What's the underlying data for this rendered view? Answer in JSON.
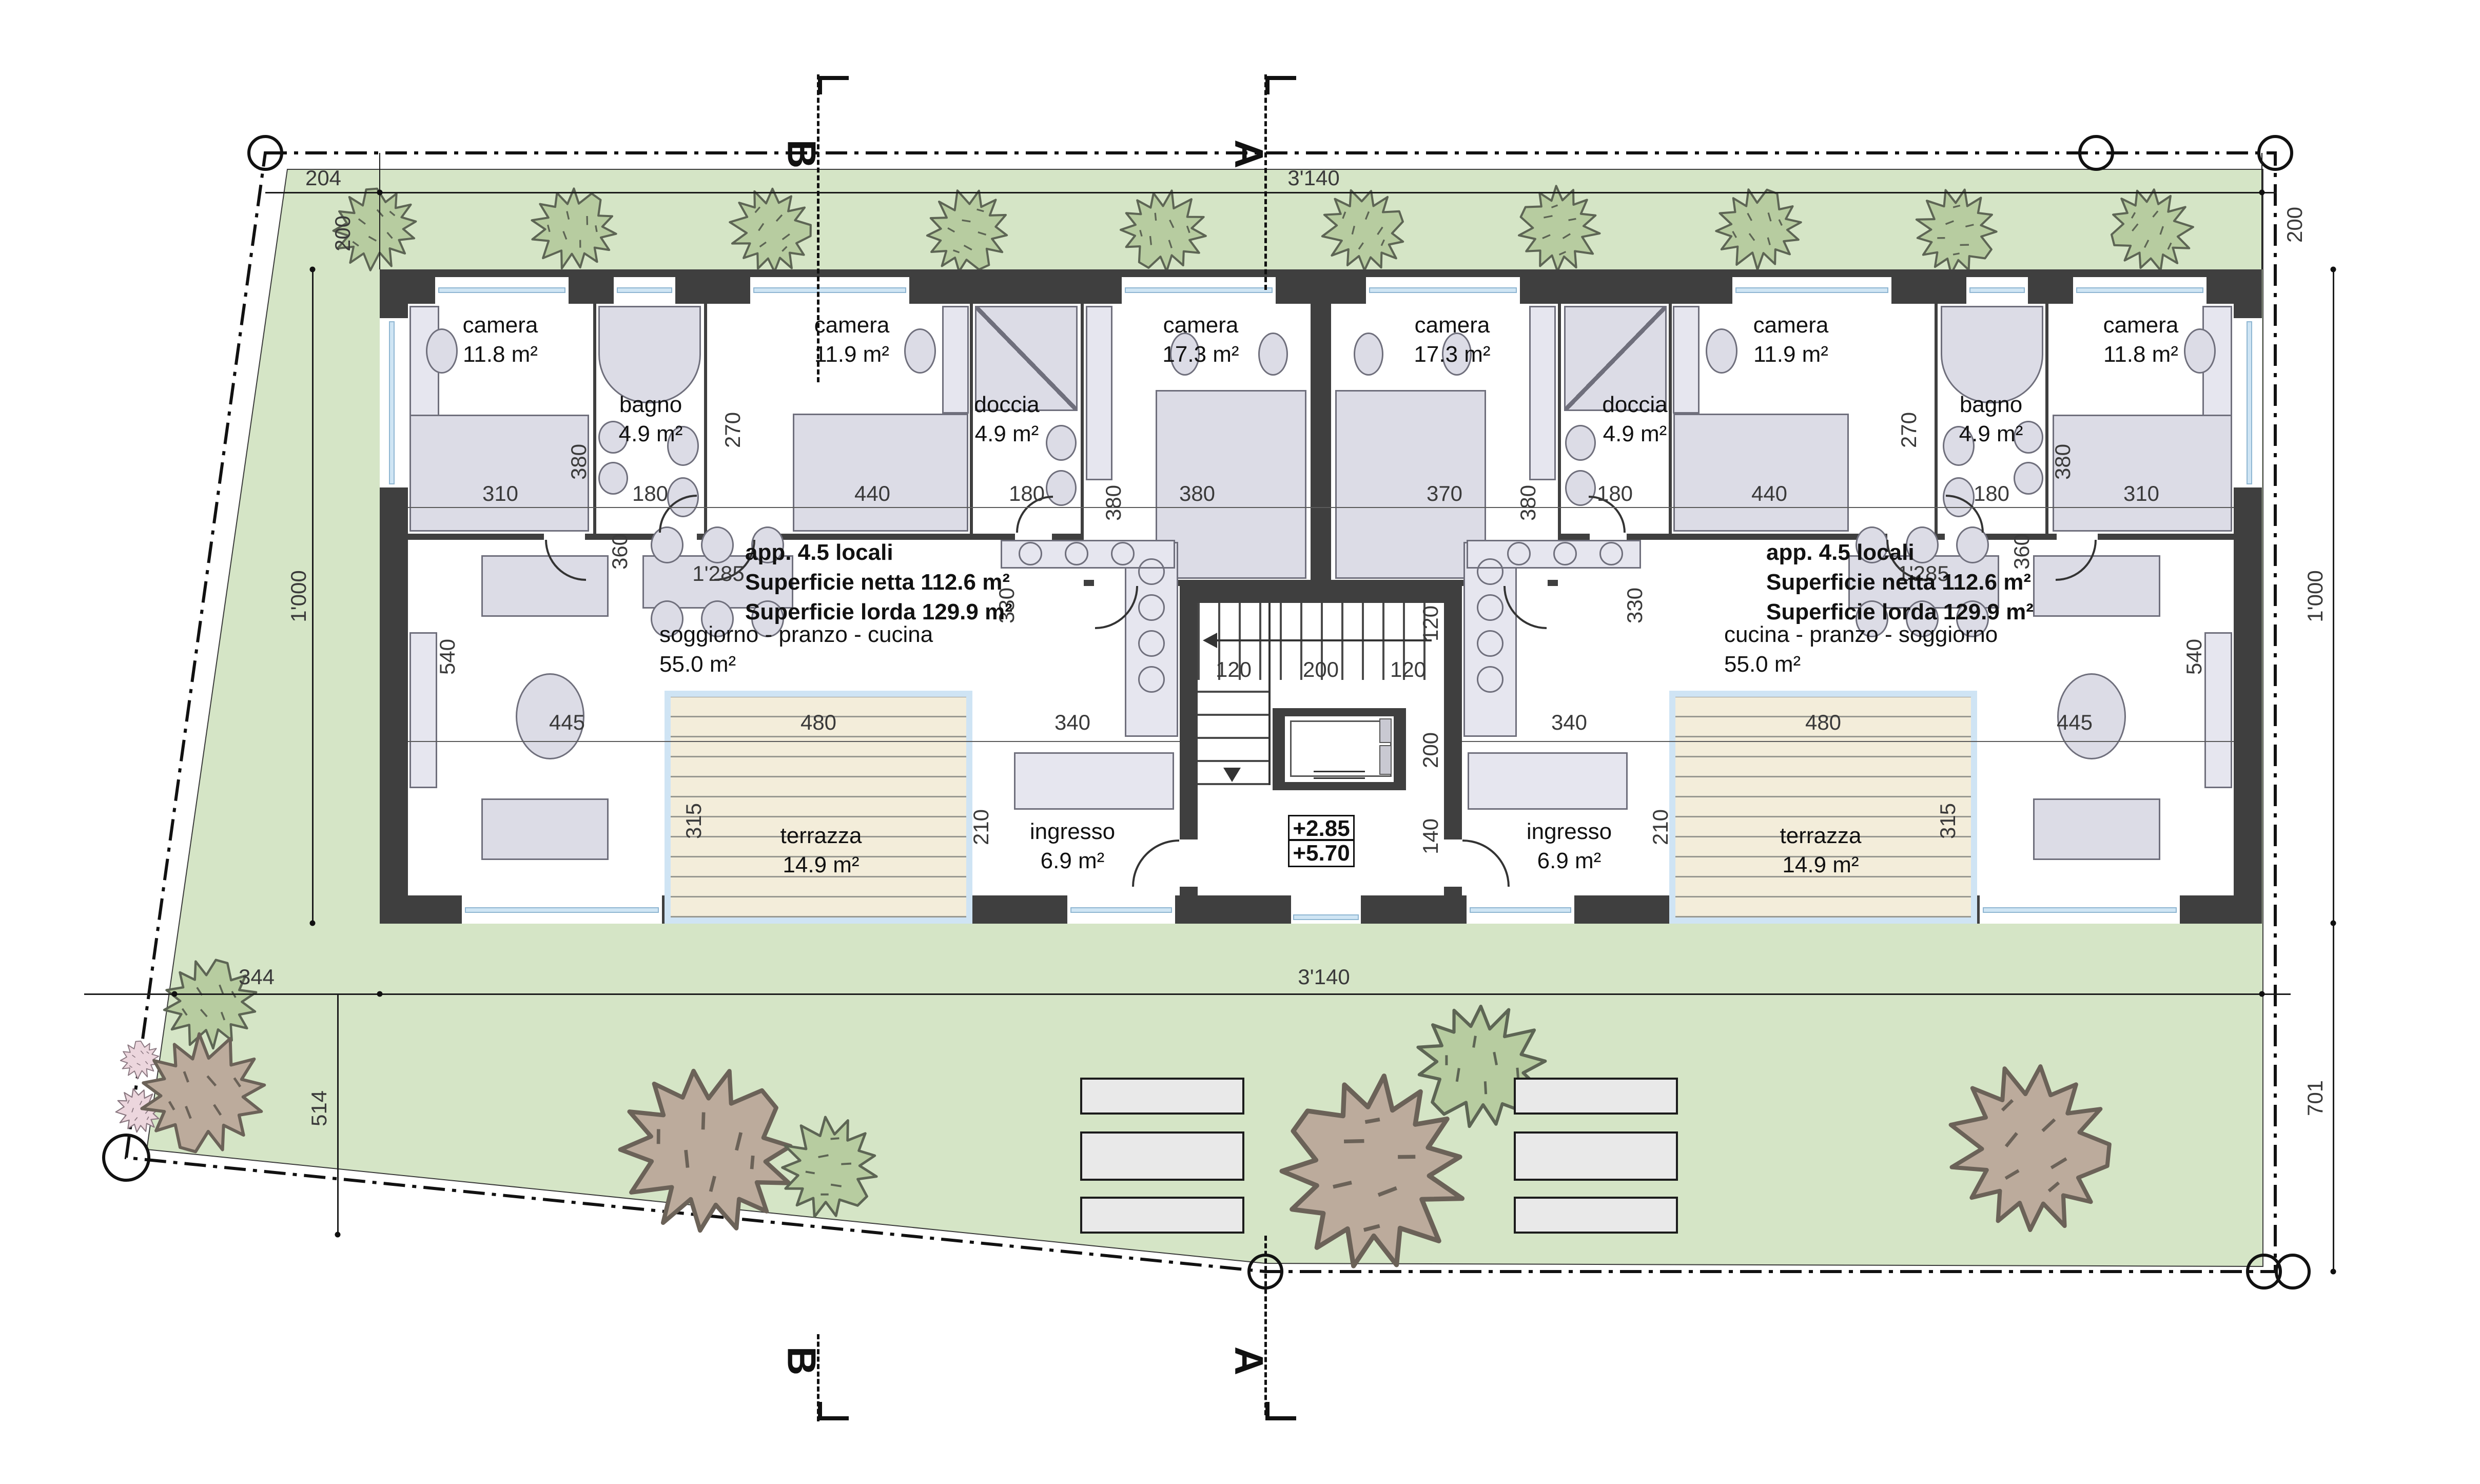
{
  "sections": {
    "a": "A",
    "b": "B"
  },
  "site_dims": {
    "top_offset": "204",
    "width_top": "3'140",
    "band_left": "200",
    "band_right": "200",
    "height_left": "1'000",
    "height_right": "1'000",
    "bottom_offset_w": "344",
    "bottom_offset_h": "514",
    "width_bottom": "3'140",
    "right_lower": "701"
  },
  "room_dims": {
    "d310": "310",
    "d180": "180",
    "d440": "440",
    "d380": "380",
    "d370": "370",
    "d270": "270",
    "d360": "360",
    "d330": "330",
    "d540": "540",
    "d445": "445",
    "d480": "480",
    "d315": "315",
    "d210": "210",
    "d340": "340",
    "d1285": "1'285",
    "d120": "120",
    "d200": "200",
    "d140": "140"
  },
  "rooms": {
    "camera": "camera",
    "area_118": "11.8 m²",
    "area_119": "11.9 m²",
    "area_173": "17.3 m²",
    "bagno": "bagno",
    "doccia": "doccia",
    "area_49": "4.9 m²",
    "living_left": "soggiorno - pranzo - cucina",
    "living_right": "cucina - pranzo - soggiorno",
    "area_55": "55.0 m²",
    "terrazza": "terrazza",
    "area_149": "14.9 m²",
    "ingresso": "ingresso",
    "area_69": "6.9 m²"
  },
  "apartment_info": {
    "title": "app. 4.5 locali",
    "net": "Superficie netta 112.6 m²",
    "gross": "Superficie lorda 129.9 m²"
  },
  "levels": {
    "upper": "+2.85",
    "roof": "+5.70"
  },
  "colors": {
    "lawn": "#d5e5c6",
    "wall": "#3f3f3f",
    "terrace_deck": "#f3edda",
    "glass": "#cfe5f4",
    "tree_green": "#b7cca0",
    "tree_brown": "#bcab9c",
    "tree_pink": "#ecd6dd",
    "furniture": "#dcdce6"
  }
}
